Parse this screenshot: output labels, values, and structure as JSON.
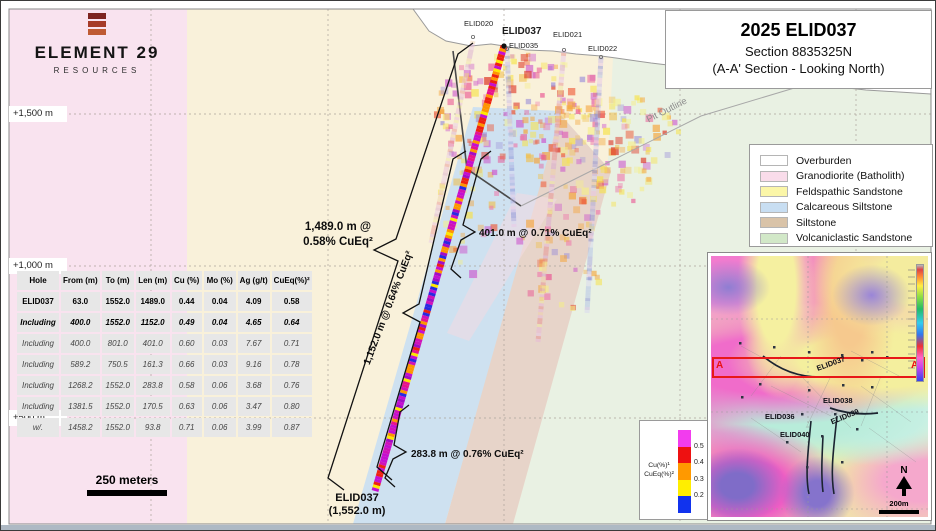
{
  "logo": {
    "name": "ELEMENT 29",
    "tagline": "RESOURCES"
  },
  "title_box": {
    "line1": "2025 ELID037",
    "line2": "Section 8835325N",
    "line3": "(A-A' Section - Looking North)"
  },
  "geology_legend": [
    {
      "label": "Overburden",
      "color": "#ffffff"
    },
    {
      "label": "Granodiorite (Batholith)",
      "color": "#f9dcea"
    },
    {
      "label": "Feldspathic Sandstone",
      "color": "#fbf6a8"
    },
    {
      "label": "Calcareous Siltstone",
      "color": "#c8def2"
    },
    {
      "label": "Siltstone",
      "color": "#d9c3a8"
    },
    {
      "label": "Volcaniclastic Sandstone",
      "color": "#d2e8c8"
    }
  ],
  "assay_table": {
    "headers": [
      "Hole",
      "From (m)",
      "To (m)",
      "Len (m)",
      "Cu (%)",
      "Mo (%)",
      "Ag (g/t)",
      "CuEq(%)²"
    ],
    "rows": [
      [
        "ELID037",
        "63.0",
        "1552.0",
        "1489.0",
        "0.44",
        "0.04",
        "4.09",
        "0.58"
      ],
      [
        "Including",
        "400.0",
        "1552.0",
        "1152.0",
        "0.49",
        "0.04",
        "4.65",
        "0.64"
      ],
      [
        "Including",
        "400.0",
        "801.0",
        "401.0",
        "0.60",
        "0.03",
        "7.67",
        "0.71"
      ],
      [
        "Including",
        "589.2",
        "750.5",
        "161.3",
        "0.66",
        "0.03",
        "9.16",
        "0.78"
      ],
      [
        "Including",
        "1268.2",
        "1552.0",
        "283.8",
        "0.58",
        "0.06",
        "3.68",
        "0.76"
      ],
      [
        "Including",
        "1381.5",
        "1552.0",
        "170.5",
        "0.63",
        "0.06",
        "3.47",
        "0.80"
      ],
      [
        "w/.",
        "1458.2",
        "1552.0",
        "93.8",
        "0.71",
        "0.06",
        "3.99",
        "0.87"
      ]
    ]
  },
  "elevations": [
    "+1,500 m",
    "+1,000 m",
    "+500 m"
  ],
  "scale_bar_label": "250 meters",
  "section": {
    "hole_labels": [
      {
        "id": "elid020",
        "label": "ELID020"
      },
      {
        "id": "elid037",
        "label": "ELID037"
      },
      {
        "id": "elid035",
        "label": "ELID035"
      },
      {
        "id": "elid021",
        "label": "ELID021"
      },
      {
        "id": "elid022",
        "label": "ELID022"
      }
    ],
    "pit_outline_label": "Pit Outline",
    "annotations": {
      "full_line1": "1,489.0 m @",
      "full_line2": "0.58% CuEq²",
      "incl_1152": "1,152.0 m @ 0.64% CuEq²",
      "incl_401": "401.0 m @ 0.71% CuEq²",
      "incl_283": "283.8 m @ 0.76% CuEq²",
      "eoh_line1": "ELID037",
      "eoh_line2": "(1,552.0 m)"
    }
  },
  "assay_scale": {
    "title_line1": "Cu(%)¹",
    "title_line2": "CuEq(%)²",
    "segments": [
      "#f23cee",
      "#ee1111",
      "#ff9900",
      "#ffee00",
      "#1133ee"
    ],
    "ticks": [
      "0.5",
      "0.4",
      "0.3",
      "0.2"
    ]
  },
  "inset": {
    "marker_left": "A",
    "marker_right": "A'",
    "north_label": "N",
    "scale_label": "200m",
    "hole_labels": [
      {
        "id": "elid037",
        "label": "ELID037"
      },
      {
        "id": "elid038",
        "label": "ELID038"
      },
      {
        "id": "elid036",
        "label": "ELID036"
      },
      {
        "id": "elid039",
        "label": "ELID039"
      },
      {
        "id": "elid040",
        "label": "ELID040"
      }
    ]
  }
}
